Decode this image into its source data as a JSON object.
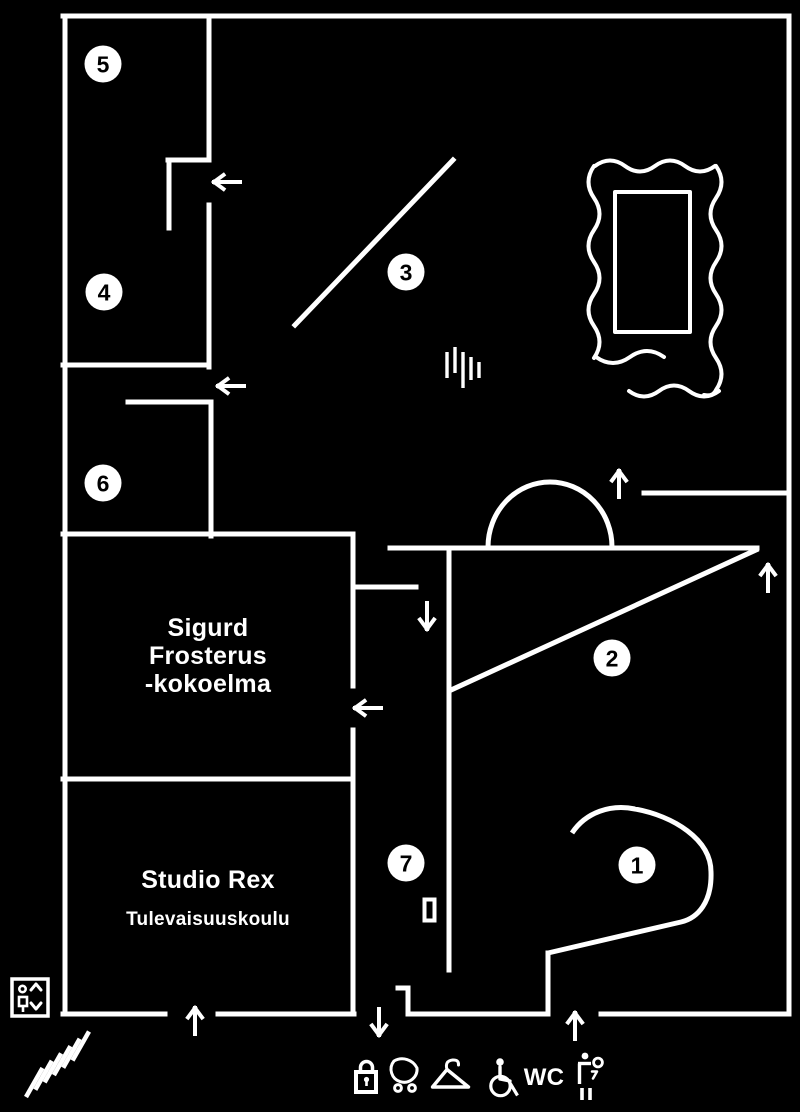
{
  "colors": {
    "background": "#000000",
    "line": "#ffffff",
    "marker_fill": "#ffffff",
    "marker_text": "#000000"
  },
  "floorplan": {
    "style": {
      "wall_width": 5,
      "arrow_width": 4,
      "arrow_length": 26,
      "arrow_head_spread": 7,
      "arrow_head_depth": 9.5,
      "marker_radius": 18.5,
      "marker_font_size": 23
    },
    "walls": [
      {
        "name": "outer-wall-top",
        "x1": 63,
        "y1": 16,
        "x2": 789,
        "y2": 16
      },
      {
        "name": "outer-wall-right",
        "x1": 789,
        "y1": 16,
        "x2": 789,
        "y2": 1014
      },
      {
        "name": "outer-wall-left",
        "x1": 65,
        "y1": 16,
        "x2": 65,
        "y2": 1014
      },
      {
        "name": "bottom-wall-segment-1",
        "x1": 63,
        "y1": 1014,
        "x2": 165,
        "y2": 1014
      },
      {
        "name": "bottom-wall-segment-2",
        "x1": 218,
        "y1": 1014,
        "x2": 354,
        "y2": 1014
      },
      {
        "name": "bottom-wall-segment-3",
        "x1": 408,
        "y1": 1014,
        "x2": 548,
        "y2": 1014
      },
      {
        "name": "bottom-wall-segment-4",
        "x1": 601,
        "y1": 1014,
        "x2": 789,
        "y2": 1014
      },
      {
        "name": "room5-east-wall",
        "x1": 209,
        "y1": 16,
        "x2": 209,
        "y2": 158
      },
      {
        "name": "room5-door-jamb",
        "x1": 168,
        "y1": 160,
        "x2": 209,
        "y2": 160
      },
      {
        "name": "room5-door-leaf",
        "x1": 169,
        "y1": 160,
        "x2": 169,
        "y2": 228
      },
      {
        "name": "room4-east-wall",
        "x1": 209,
        "y1": 205,
        "x2": 209,
        "y2": 367
      },
      {
        "name": "room4-south-wall",
        "x1": 63,
        "y1": 365,
        "x2": 209,
        "y2": 365
      },
      {
        "name": "room6-north-wall",
        "x1": 128,
        "y1": 402,
        "x2": 211,
        "y2": 402
      },
      {
        "name": "room6-east-wall",
        "x1": 211,
        "y1": 402,
        "x2": 211,
        "y2": 536
      },
      {
        "name": "room6-south-sigurd-north-wall",
        "x1": 63,
        "y1": 534,
        "x2": 353,
        "y2": 534
      },
      {
        "name": "sigurd-east-wall-upper",
        "x1": 353,
        "y1": 534,
        "x2": 353,
        "y2": 686
      },
      {
        "name": "sigurd-east-wall-lower",
        "x1": 353,
        "y1": 730,
        "x2": 353,
        "y2": 1014
      },
      {
        "name": "studio-rex-north-wall",
        "x1": 63,
        "y1": 779,
        "x2": 353,
        "y2": 779
      },
      {
        "name": "hall-stub-wall",
        "x1": 353,
        "y1": 587,
        "x2": 416,
        "y2": 587
      },
      {
        "name": "hall-long-wall",
        "x1": 390,
        "y1": 548,
        "x2": 757,
        "y2": 548
      },
      {
        "name": "room2-west-wall",
        "x1": 449,
        "y1": 548,
        "x2": 449,
        "y2": 970
      },
      {
        "name": "room2-diagonal-wall",
        "x1": 756,
        "y1": 550,
        "x2": 451,
        "y2": 690
      },
      {
        "name": "room3-diagonal-wall",
        "x1": 295,
        "y1": 325,
        "x2": 453,
        "y2": 160
      },
      {
        "name": "northeast-wall",
        "x1": 644,
        "y1": 493,
        "x2": 789,
        "y2": 493
      },
      {
        "name": "entrance-jamb-horizontal",
        "x1": 398,
        "y1": 988,
        "x2": 408,
        "y2": 988
      },
      {
        "name": "entrance-jamb-vertical",
        "x1": 408,
        "y1": 988,
        "x2": 408,
        "y2": 1014
      },
      {
        "name": "room1-tail-wall-vertical",
        "x1": 548,
        "y1": 953,
        "x2": 548,
        "y2": 1014
      }
    ],
    "curves": [
      {
        "name": "room2-arch",
        "d": "M488,547 A62,65 0 0 1 612,547",
        "w": 5,
        "cap": "butt"
      },
      {
        "name": "room1-spiral-wall",
        "d": "M572,833 C586,812 611,804 635,809 C673,816 711,839 711,872 C712,902 698,918 681,922 L548,953",
        "w": 5,
        "cap": "butt"
      },
      {
        "name": "picture-frame-top",
        "d": "M595,166 q15,-11 30,0 t30,0 t30,0 t30,0",
        "w": 4,
        "cap": "round"
      },
      {
        "name": "picture-frame-left",
        "d": "M594,166 q-11,16 0,32 t0,32 t0,32 t0,32 t0,32 t0,32",
        "w": 4,
        "cap": "round"
      },
      {
        "name": "picture-frame-right",
        "d": "M716,166 q11,16 0,32 t0,32 t0,32 t0,32 t0,32 t0,32 t0,32 q-3,7 -12,5",
        "w": 4,
        "cap": "round"
      },
      {
        "name": "picture-frame-bottom",
        "d": "M596,357 q17,12 34,0 t34,0",
        "w": 4,
        "cap": "round"
      },
      {
        "name": "picture-frame-underline",
        "d": "M629,391 q15,11 30,0 t30,0 t30,0",
        "w": 4,
        "cap": "round"
      },
      {
        "name": "picture-frame-inner",
        "d": "M615,192 h75 v140 h-75 Z",
        "w": 4,
        "cap": "butt"
      }
    ],
    "arrows": [
      {
        "name": "arrow-door-room5",
        "dir": "left",
        "x": 214,
        "y": 182
      },
      {
        "name": "arrow-door-room6",
        "dir": "left",
        "x": 218,
        "y": 386
      },
      {
        "name": "arrow-door-sigurd",
        "dir": "left",
        "x": 355,
        "y": 708
      },
      {
        "name": "arrow-hall-down",
        "dir": "down",
        "x": 427,
        "y": 629
      },
      {
        "name": "arrow-room2-to-room3",
        "dir": "up",
        "x": 619,
        "y": 471
      },
      {
        "name": "arrow-room2-northeast",
        "dir": "up",
        "x": 768,
        "y": 565
      },
      {
        "name": "arrow-studio-rex-entry",
        "dir": "up",
        "x": 195,
        "y": 1008
      },
      {
        "name": "arrow-exit-down",
        "dir": "down",
        "x": 379,
        "y": 1035
      },
      {
        "name": "arrow-main-entrance",
        "dir": "up",
        "x": 575,
        "y": 1013
      }
    ],
    "room_markers": [
      {
        "number": "1",
        "x": 637,
        "y": 865
      },
      {
        "number": "2",
        "x": 612,
        "y": 658
      },
      {
        "number": "3",
        "x": 406,
        "y": 272
      },
      {
        "number": "4",
        "x": 104,
        "y": 292
      },
      {
        "number": "5",
        "x": 103,
        "y": 64
      },
      {
        "number": "6",
        "x": 103,
        "y": 483
      },
      {
        "number": "7",
        "x": 406,
        "y": 863
      }
    ],
    "labels": [
      {
        "name": "label-sigurd-line1",
        "text": "Sigurd",
        "x": 208,
        "y": 636,
        "size": 25,
        "weight": 600
      },
      {
        "name": "label-sigurd-line2",
        "text": "Frosterus",
        "x": 208,
        "y": 664,
        "size": 25,
        "weight": 600
      },
      {
        "name": "label-sigurd-line3",
        "text": "-kokoelma",
        "x": 208,
        "y": 692,
        "size": 25,
        "weight": 600
      },
      {
        "name": "label-studio-rex",
        "text": "Studio Rex",
        "x": 208,
        "y": 888,
        "size": 25,
        "weight": 600
      },
      {
        "name": "label-tulevaisuuskoulu",
        "text": "Tulevaisuuskoulu",
        "x": 208,
        "y": 925,
        "size": 19,
        "weight": 600
      },
      {
        "name": "wc-label",
        "text": "WC",
        "x": 544,
        "y": 1085,
        "size": 24,
        "weight": 700
      }
    ],
    "icons": [
      {
        "name": "sound-waves-icon",
        "shapes": [
          {
            "t": "line",
            "p": [
              447,
              352,
              447,
              378
            ],
            "w": 3.4
          },
          {
            "t": "line",
            "p": [
              455,
              347,
              455,
              373
            ],
            "w": 3.4
          },
          {
            "t": "line",
            "p": [
              463,
              352,
              463,
              388
            ],
            "w": 3.4
          },
          {
            "t": "line",
            "p": [
              471,
              357,
              471,
              380
            ],
            "w": 3.4
          },
          {
            "t": "line",
            "p": [
              479,
              362,
              479,
              378
            ],
            "w": 3.4
          }
        ]
      },
      {
        "name": "room7-door-rectangle",
        "shapes": [
          {
            "t": "rect",
            "p": [
              424.5,
              899.5,
              10,
              21
            ],
            "w": 4
          }
        ]
      },
      {
        "name": "elevator-icon",
        "shapes": [
          {
            "t": "rect",
            "p": [
              12,
              979,
              36,
              37
            ],
            "w": 3.5
          },
          {
            "t": "circle",
            "p": [
              22.5,
              989,
              3.2
            ],
            "w": 2.6
          },
          {
            "t": "rect",
            "p": [
              19,
              997,
              8,
              9
            ],
            "w": 2.6
          },
          {
            "t": "line",
            "p": [
              23,
              1006,
              23,
              1012
            ],
            "w": 2.6
          },
          {
            "t": "path",
            "d": "M31,990 l5,-6 l5,6",
            "w": 3
          },
          {
            "t": "path",
            "d": "M31,1003 l5,6 l5,-6",
            "w": 3
          }
        ]
      },
      {
        "name": "stairs-icon",
        "shapes": [
          {
            "t": "line",
            "p": [
              26,
              1097,
              42.5,
              1068
            ],
            "w": 4.5
          },
          {
            "t": "line",
            "p": [
              35.3,
              1089.7,
              51.8,
              1060.7
            ],
            "w": 4.5
          },
          {
            "t": "line",
            "p": [
              44.6,
              1082.4,
              61.1,
              1053.4
            ],
            "w": 4.5
          },
          {
            "t": "line",
            "p": [
              53.9,
              1075.1,
              70.4,
              1046.1
            ],
            "w": 4.5
          },
          {
            "t": "line",
            "p": [
              63.2,
              1067.8,
              79.7,
              1038.8
            ],
            "w": 4.5
          },
          {
            "t": "line",
            "p": [
              72.5,
              1060.5,
              89,
              1031.5
            ],
            "w": 4.5
          }
        ]
      },
      {
        "name": "lock-icon",
        "shapes": [
          {
            "t": "rect",
            "p": [
              356,
              1072,
              20,
              20
            ],
            "w": 4
          },
          {
            "t": "path",
            "d": "M360.5,1070 v-2.5 a6,6 0 0 1 12,0 v2.5",
            "w": 3.5
          },
          {
            "t": "circle",
            "p": [
              366.5,
              1079.5,
              2.6
            ],
            "fill": true
          },
          {
            "t": "line",
            "p": [
              366.5,
              1080,
              366.5,
              1086
            ],
            "w": 2.6
          }
        ]
      },
      {
        "name": "stroller-icon",
        "shapes": [
          {
            "t": "path",
            "d": "M394,1061 A13,13 0 1 0 417,1068 A16.5,16.5 0 0 0 394,1061 Z",
            "w": 3
          },
          {
            "t": "circle",
            "p": [
              398,
              1088,
              3.4
            ],
            "w": 3
          },
          {
            "t": "circle",
            "p": [
              412,
              1088,
              3.4
            ],
            "w": 3
          }
        ]
      },
      {
        "name": "coat-hanger-icon",
        "shapes": [
          {
            "t": "path",
            "d": "M432.5,1087 L447,1069.5 L468.5,1087 Z",
            "w": 3.4
          },
          {
            "t": "path",
            "d": "M447,1069.5 q-2.5,-8.5 5.5,-9.5 q6.5,-0.5 6,5",
            "w": 3
          }
        ]
      },
      {
        "name": "wheelchair-icon",
        "shapes": [
          {
            "t": "circle",
            "p": [
              500,
              1062,
              3.8
            ],
            "fill": true
          },
          {
            "t": "circle",
            "p": [
              500.5,
              1086,
              9.7
            ],
            "w": 3.2
          },
          {
            "t": "path",
            "d": "M500,1067 L500,1079 L510,1081",
            "w": 3.4
          },
          {
            "t": "line",
            "p": [
              510,
              1083,
              517.5,
              1095.5
            ],
            "w": 3.2
          }
        ]
      },
      {
        "name": "baby-changing-icon",
        "shapes": [
          {
            "t": "circle",
            "p": [
              585,
              1056,
              3.4
            ],
            "fill": true
          },
          {
            "t": "line",
            "p": [
              579.5,
              1063.5,
              579.5,
              1084
            ],
            "w": 3.4
          },
          {
            "t": "line",
            "p": [
              578,
              1063.5,
              591,
              1063.5
            ],
            "w": 3.4
          },
          {
            "t": "circle",
            "p": [
              598,
              1062.5,
              4.4
            ],
            "w": 2.8
          },
          {
            "t": "path",
            "d": "M592,1071.5 h5 l-4,7",
            "w": 2.5
          },
          {
            "t": "line",
            "p": [
              582,
              1088,
              582,
              1100
            ],
            "w": 3.6
          },
          {
            "t": "line",
            "p": [
              590,
              1088,
              590,
              1100
            ],
            "w": 3.6
          }
        ]
      }
    ]
  }
}
